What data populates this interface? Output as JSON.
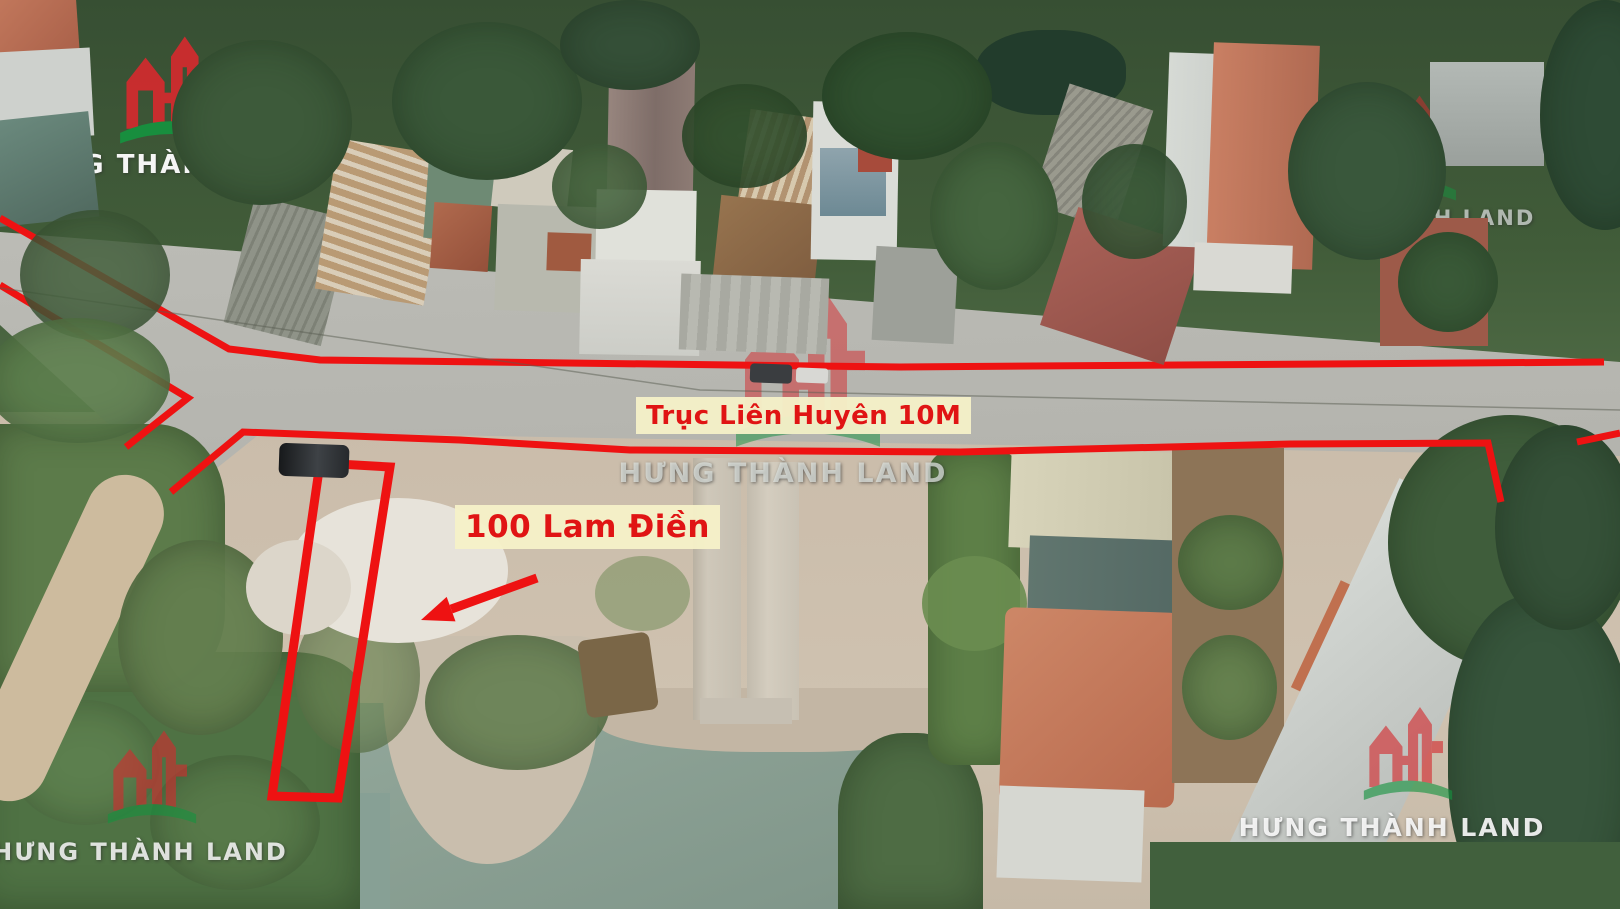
{
  "image": {
    "width": 1620,
    "height": 909
  },
  "watermarks": {
    "brand_text": "HƯNG THÀNH LAND",
    "logo_red": "#d42a2e",
    "logo_green": "#15933f",
    "instances": [
      {
        "id": "top-left",
        "cx": 170,
        "logo_x": 118,
        "logo_y": 22,
        "logo_w": 106,
        "logo_h": 136,
        "logo_o": 0.92,
        "text_y": 150,
        "text_size": 26,
        "text_color": "rgba(253,253,253,0.96)"
      },
      {
        "id": "center",
        "cx": 783,
        "logo_x": 733,
        "logo_y": 283,
        "logo_w": 150,
        "logo_h": 176,
        "logo_o": 0.5,
        "text_y": 458,
        "text_size": 27,
        "text_color": "rgba(222,227,223,0.75)"
      },
      {
        "id": "right",
        "cx": 1404,
        "logo_x": 1354,
        "logo_y": 86,
        "logo_w": 104,
        "logo_h": 124,
        "logo_o": 0.5,
        "text_y": 206,
        "text_size": 21,
        "text_color": "rgba(206,212,208,0.8)"
      },
      {
        "id": "bottom-left",
        "cx": 140,
        "logo_x": 106,
        "logo_y": 720,
        "logo_w": 92,
        "logo_h": 114,
        "logo_o": 0.6,
        "text_y": 838,
        "text_size": 24,
        "text_color": "rgba(250,250,250,0.85)"
      },
      {
        "id": "bottom-right",
        "cx": 1392,
        "logo_x": 1362,
        "logo_y": 696,
        "logo_w": 92,
        "logo_h": 115,
        "logo_o": 0.62,
        "text_y": 813,
        "text_size": 25,
        "text_color": "rgba(252,252,252,0.9)"
      }
    ]
  },
  "annotations": {
    "color": "#ee1212",
    "stroke_width": 7,
    "road_label": {
      "text": "Trục Liên Huyên 10M",
      "x": 636,
      "y": 397,
      "w": 312,
      "h": 37,
      "font_size": 26,
      "text_color": "#e01414",
      "bg_color": "rgba(245,241,200,0.95)"
    },
    "plot_label": {
      "text": "100 Lam Điền",
      "x": 455,
      "y": 505,
      "w": 214,
      "h": 44,
      "font_size": 31,
      "text_color": "#e01414",
      "bg_color": "rgba(245,241,200,0.95)"
    },
    "lines": [
      {
        "name": "road-top-edge-line",
        "points": [
          [
            0,
            218
          ],
          [
            229,
            349
          ],
          [
            320,
            360
          ],
          [
            900,
            367
          ],
          [
            1604,
            362
          ]
        ]
      },
      {
        "name": "road-left-branch-line",
        "points": [
          [
            0,
            285
          ],
          [
            188,
            398
          ],
          [
            126,
            447
          ]
        ]
      },
      {
        "name": "road-bottom-edge-line",
        "points": [
          [
            171,
            492
          ],
          [
            243,
            432
          ],
          [
            460,
            440
          ],
          [
            630,
            450
          ],
          [
            960,
            452
          ],
          [
            1290,
            444
          ],
          [
            1488,
            443
          ],
          [
            1501,
            502
          ]
        ]
      },
      {
        "name": "road-bottom-edge-line-right",
        "points": [
          [
            1577,
            442
          ],
          [
            1620,
            433
          ]
        ]
      },
      {
        "name": "power-line",
        "points": [
          [
            0,
            288
          ],
          [
            700,
            390
          ],
          [
            1620,
            410
          ]
        ],
        "stroke": "#5a5d52",
        "width": 1.5,
        "opacity": 0.5
      }
    ],
    "plot_outline": {
      "points": [
        [
          320,
          463
        ],
        [
          390,
          467
        ],
        [
          338,
          798
        ],
        [
          272,
          796
        ]
      ],
      "stroke_width": 9
    },
    "arrow": {
      "tail": [
        537,
        578
      ],
      "head": [
        421,
        620
      ],
      "stroke_width": 9
    }
  },
  "scene": {
    "elements": [
      {
        "n": "tree-canopy-top",
        "x": 0,
        "y": 0,
        "w": 1620,
        "h": 448,
        "bg": "linear-gradient(180deg,#374f33 0%,#415c39 55%,#54704a 100%)"
      },
      {
        "n": "ground-lot",
        "x": 0,
        "y": 412,
        "w": 1620,
        "h": 497,
        "bg": "linear-gradient(180deg,#cabcaa,#cfc2b0 60%,#c6b9a7)"
      },
      {
        "n": "road",
        "x": 0,
        "y": 210,
        "w": 1620,
        "h": 266,
        "bg": "linear-gradient(178deg,#bcbcb6,#b3b3ad)",
        "clip": "0px 22px,1620px 152px,1620px 246px,262px 222px,212px 262px,150px 252px,0px 115px"
      },
      {
        "n": "pond-water",
        "x": 295,
        "y": 703,
        "w": 655,
        "h": 206,
        "bg": "linear-gradient(160deg,#93a89b,#7e9488)"
      },
      {
        "n": "pond-inlet-left",
        "x": 298,
        "y": 793,
        "w": 92,
        "h": 116,
        "c": "#87a095"
      },
      {
        "n": "lot-peninsula",
        "x": 383,
        "y": 636,
        "w": 216,
        "h": 228,
        "c": "#c9bead",
        "br": "6% 10% 52% 48% / 4% 6% 72% 76%"
      },
      {
        "n": "lot-shore-strip",
        "x": 598,
        "y": 688,
        "w": 352,
        "h": 64,
        "c": "#c3b6a4",
        "br": "0 0 40% 45%"
      },
      {
        "n": "hyacinth-mat",
        "x": -25,
        "y": 652,
        "w": 385,
        "h": 257,
        "c": "#4f7244",
        "br": "36% 18% 0 0 / 22% 14% 0 0",
        "soft": 1
      },
      {
        "n": "hyacinth-patch",
        "x": 10,
        "y": 700,
        "w": 150,
        "h": 125,
        "c": "#5f8250",
        "br": "50%",
        "o": 0.85,
        "soft": 1
      },
      {
        "n": "hyacinth-patch",
        "x": 150,
        "y": 755,
        "w": 170,
        "h": 135,
        "c": "#587a4a",
        "br": "50%",
        "o": 0.9,
        "soft": 1
      },
      {
        "n": "bank-vegetation-left",
        "x": -10,
        "y": 424,
        "w": 235,
        "h": 268,
        "c": "#5c7b4a",
        "br": "0 30% 30% 0",
        "soft": 1
      },
      {
        "n": "dirt-footpath",
        "x": 28,
        "y": 462,
        "w": 78,
        "h": 352,
        "c": "#cdbb9e",
        "r": 25,
        "br": "40px"
      },
      {
        "n": "lot-shrub",
        "x": 118,
        "y": 540,
        "w": 165,
        "h": 195,
        "c": "#647f4f",
        "br": "50%",
        "o": 0.95,
        "soft": 1
      },
      {
        "n": "lot-shrub",
        "x": 295,
        "y": 598,
        "w": 125,
        "h": 155,
        "c": "#6d8655",
        "br": "50%",
        "o": 0.7,
        "soft": 1
      },
      {
        "n": "lot-shrub",
        "x": 425,
        "y": 635,
        "w": 185,
        "h": 135,
        "c": "#5f7c4c",
        "br": "50%",
        "o": 0.85,
        "soft": 1
      },
      {
        "n": "lot-shrub",
        "x": 595,
        "y": 556,
        "w": 95,
        "h": 75,
        "c": "#7b9160",
        "br": "50%",
        "o": 0.6
      },
      {
        "n": "rubble-pile",
        "x": 288,
        "y": 498,
        "w": 220,
        "h": 145,
        "c": "#e7e3da",
        "br": "50%"
      },
      {
        "n": "rubble-pile",
        "x": 246,
        "y": 540,
        "w": 105,
        "h": 95,
        "c": "#dcd6ca",
        "br": "50%"
      },
      {
        "n": "concrete-strip",
        "x": 693,
        "y": 458,
        "w": 48,
        "h": 262,
        "bg": "linear-gradient(90deg,#b9b1a2,#cfc8ba 30%,#c5beb0)"
      },
      {
        "n": "concrete-strip",
        "x": 747,
        "y": 462,
        "w": 52,
        "h": 258,
        "bg": "linear-gradient(90deg,#c2bbad,#d4cdbf 40%,#c9c2b4)"
      },
      {
        "n": "concrete-pad",
        "x": 700,
        "y": 698,
        "w": 92,
        "h": 26,
        "c": "#c6bfb2"
      },
      {
        "n": "lakeside-hut",
        "x": 582,
        "y": 636,
        "w": 72,
        "h": 78,
        "c": "#7a6647",
        "r": -8,
        "br": "8px"
      },
      {
        "n": "shore-vegetation",
        "x": 838,
        "y": 733,
        "w": 145,
        "h": 176,
        "c": "#4e6c44",
        "br": "45% 45% 0 0",
        "soft": 1
      },
      {
        "n": "banana-strip",
        "x": 928,
        "y": 450,
        "w": 92,
        "h": 315,
        "c": "#5e8048",
        "br": "24px",
        "soft": 1
      },
      {
        "n": "banana-clump",
        "x": 922,
        "y": 556,
        "w": 105,
        "h": 95,
        "c": "#6a8d50",
        "br": "50%",
        "o": 0.9
      },
      {
        "n": "warehouse-roof-light",
        "x": 1010,
        "y": 450,
        "w": 165,
        "h": 100,
        "bg": "linear-gradient(90deg,#d8d4ba,#c8c4aa)",
        "r": 2
      },
      {
        "n": "warehouse-roof-dark",
        "x": 1028,
        "y": 538,
        "w": 150,
        "h": 110,
        "bg": "linear-gradient(90deg,#61766f,#546964)",
        "r": 2
      },
      {
        "n": "hip-roof-house-salmon",
        "x": 1002,
        "y": 610,
        "w": 175,
        "h": 195,
        "bg": "linear-gradient(135deg,#cd8767,#b96a4e)",
        "r": 2,
        "br": "10px"
      },
      {
        "n": "house-wall-white",
        "x": 998,
        "y": 788,
        "w": 145,
        "h": 92,
        "c": "#d6d7d1",
        "r": 2
      },
      {
        "n": "garden-plot",
        "x": 1172,
        "y": 448,
        "w": 112,
        "h": 335,
        "c": "#8d7457"
      },
      {
        "n": "garden-shrub",
        "x": 1178,
        "y": 515,
        "w": 105,
        "h": 95,
        "c": "#5d7b49",
        "br": "50%",
        "soft": 1
      },
      {
        "n": "garden-shrub",
        "x": 1182,
        "y": 635,
        "w": 95,
        "h": 105,
        "c": "#66824f",
        "br": "50%",
        "soft": 1
      },
      {
        "n": "long-building-upper",
        "x": 1412,
        "y": 462,
        "w": 115,
        "h": 140,
        "c": "#c6cbc7",
        "r": 25
      },
      {
        "n": "orange-roof-corner",
        "x": 1312,
        "y": 592,
        "w": 82,
        "h": 118,
        "c": "#c0704f",
        "r": 25
      },
      {
        "n": "long-building-gray",
        "x": 1302,
        "y": 488,
        "w": 142,
        "h": 430,
        "bg": "linear-gradient(115deg,#d6dad6,#b7bbb7)",
        "r": 25
      },
      {
        "n": "tree-cluster",
        "x": 1388,
        "y": 415,
        "w": 245,
        "h": 255,
        "c": "#3f5d3b",
        "br": "50%",
        "soft": 1
      },
      {
        "n": "tree-cluster",
        "x": 1448,
        "y": 595,
        "w": 185,
        "h": 330,
        "c": "#37553c",
        "br": "45%",
        "soft": 1
      },
      {
        "n": "tree-cluster",
        "x": 1495,
        "y": 425,
        "w": 140,
        "h": 205,
        "c": "#355138",
        "br": "50%",
        "soft": 1
      },
      {
        "n": "shore-vegetation",
        "x": 1150,
        "y": 842,
        "w": 490,
        "h": 70,
        "c": "#41603d"
      },
      {
        "n": "roof-orange-tl",
        "x": -6,
        "y": -8,
        "w": 84,
        "h": 74,
        "bg": "linear-gradient(135deg,#c3795d,#a85f48)",
        "r": -4
      },
      {
        "n": "building-white-tl",
        "x": -4,
        "y": 50,
        "w": 96,
        "h": 88,
        "c": "#ced1cd",
        "r": -3
      },
      {
        "n": "roof-teal-tl",
        "x": -6,
        "y": 116,
        "w": 100,
        "h": 106,
        "bg": "linear-gradient(160deg,#6b8a7e,#50695f)",
        "r": -6
      },
      {
        "n": "roof-corrugated-gray",
        "x": 238,
        "y": 206,
        "w": 100,
        "h": 130,
        "bg": "repeating-linear-gradient(100deg,#8f9388 0px,#8f9388 6px,#7d8176 6px,#7d8176 9px)",
        "r": 14
      },
      {
        "n": "roof-rust-striped",
        "x": 326,
        "y": 146,
        "w": 110,
        "h": 152,
        "bg": "repeating-linear-gradient(10deg,#b99a74 0px,#b99a74 7px,#d9cdb8 7px,#d9cdb8 12px)",
        "r": 9
      },
      {
        "n": "roof-green-shed",
        "x": 436,
        "y": 90,
        "w": 104,
        "h": 94,
        "bg": "linear-gradient(180deg,#64836d,#4f6a58)",
        "r": 4
      },
      {
        "n": "roof-green-shed",
        "x": 426,
        "y": 160,
        "w": 66,
        "h": 80,
        "c": "#6e8a74",
        "r": 4
      },
      {
        "n": "roof-red-tile-small",
        "x": 432,
        "y": 204,
        "w": 58,
        "h": 66,
        "bg": "linear-gradient(135deg,#b06a4e,#94503a)",
        "r": 4
      },
      {
        "n": "shed-white",
        "x": 494,
        "y": 146,
        "w": 76,
        "h": 64,
        "c": "#cfcabc",
        "r": 6
      },
      {
        "n": "house-concrete-flat",
        "x": 496,
        "y": 206,
        "w": 122,
        "h": 106,
        "c": "#b8b9ae",
        "r": 2
      },
      {
        "n": "roof-red-gable-small",
        "x": 547,
        "y": 233,
        "w": 44,
        "h": 38,
        "c": "#a05a40",
        "r": 2
      },
      {
        "n": "church-roof",
        "x": 608,
        "y": 50,
        "w": 86,
        "h": 158,
        "bg": "linear-gradient(90deg,#97857e,#7e6d68 55%,#8d7b74)",
        "r": 1
      },
      {
        "n": "church-body",
        "x": 596,
        "y": 190,
        "w": 100,
        "h": 80,
        "c": "#e0e1da",
        "r": 1
      },
      {
        "n": "church-courtyard",
        "x": 580,
        "y": 260,
        "w": 120,
        "h": 95,
        "bg": "linear-gradient(180deg,#dbdbd5,#cccdc7)",
        "r": 1
      },
      {
        "n": "roof-rust-striped",
        "x": 742,
        "y": 114,
        "w": 82,
        "h": 118,
        "bg": "repeating-linear-gradient(100deg,#b29371 0px,#b29371 6px,#d7c9ae 6px,#d7c9ae 11px)",
        "r": 8
      },
      {
        "n": "roof-brown-hip",
        "x": 716,
        "y": 200,
        "w": 102,
        "h": 96,
        "bg": "linear-gradient(135deg,#97744f,#7d5b3e)",
        "r": 6
      },
      {
        "n": "warehouse-roof-gray",
        "x": 680,
        "y": 276,
        "w": 148,
        "h": 76,
        "bg": "repeating-linear-gradient(92deg,#a8a9a1 0px,#a8a9a1 10px,#b8b9b1 10px,#b8b9b1 20px)",
        "r": 2
      },
      {
        "n": "building-modern-white",
        "x": 812,
        "y": 102,
        "w": 86,
        "h": 158,
        "c": "#dadcd7",
        "r": 1
      },
      {
        "n": "glass-facade",
        "x": 820,
        "y": 148,
        "w": 66,
        "h": 68,
        "bg": "linear-gradient(180deg,#8fa4ad,#6d8994)"
      },
      {
        "n": "roof-red-patch",
        "x": 858,
        "y": 142,
        "w": 34,
        "h": 30,
        "c": "#a74b3b"
      },
      {
        "n": "roof-gray-small",
        "x": 874,
        "y": 248,
        "w": 82,
        "h": 94,
        "c": "#9da099",
        "r": 3
      },
      {
        "n": "pond-top-right",
        "x": 976,
        "y": 30,
        "w": 150,
        "h": 85,
        "c": "#223c2c",
        "br": "45%"
      },
      {
        "n": "roof-shingle-gray",
        "x": 1048,
        "y": 94,
        "w": 88,
        "h": 126,
        "bg": "repeating-linear-gradient(115deg,#9a9a8e 0px,#9a9a8e 5px,#85857b 5px,#85857b 8px)",
        "r": 18
      },
      {
        "n": "roof-maroon",
        "x": 1056,
        "y": 224,
        "w": 130,
        "h": 124,
        "bg": "linear-gradient(135deg,#aa6258,#8f4e46)",
        "r": 18
      },
      {
        "n": "roof-white-long",
        "x": 1166,
        "y": 54,
        "w": 106,
        "h": 194,
        "bg": "linear-gradient(90deg,#d6dad5,#c3c7c3)",
        "r": 2
      },
      {
        "n": "roof-salmon-long",
        "x": 1210,
        "y": 44,
        "w": 106,
        "h": 224,
        "bg": "linear-gradient(90deg,#c97f63,#b06a52)",
        "r": 2
      },
      {
        "n": "house-wall-white",
        "x": 1194,
        "y": 244,
        "w": 98,
        "h": 48,
        "c": "#d9d9d3",
        "r": 2
      },
      {
        "n": "courtyard-red",
        "x": 1380,
        "y": 218,
        "w": 108,
        "h": 128,
        "c": "#9d5a49"
      },
      {
        "n": "tree-blob",
        "x": 1398,
        "y": 232,
        "w": 100,
        "h": 100,
        "c": "#3a5a38",
        "br": "50%",
        "soft": 1
      },
      {
        "n": "roof-metal-gray",
        "x": 1430,
        "y": 62,
        "w": 114,
        "h": 104,
        "bg": "linear-gradient(180deg,#b3b9b5,#9aa09c)"
      },
      {
        "n": "vehicle-dark",
        "x": 750,
        "y": 364,
        "w": 42,
        "h": 19,
        "c": "#3a3d40",
        "br": "4px",
        "r": 2
      },
      {
        "n": "vehicle-light",
        "x": 796,
        "y": 368,
        "w": 32,
        "h": 15,
        "c": "#d8d8d4",
        "br": "3px",
        "r": 2
      },
      {
        "n": "tree-canopy",
        "x": 392,
        "y": 22,
        "w": 190,
        "h": 158,
        "c": "#3a5839",
        "br": "50%",
        "soft": 1
      },
      {
        "n": "tree-canopy",
        "x": 552,
        "y": 144,
        "w": 95,
        "h": 85,
        "c": "#4c6a44",
        "br": "50%",
        "o": 0.9,
        "soft": 1
      },
      {
        "n": "tree-canopy",
        "x": 560,
        "y": 0,
        "w": 140,
        "h": 90,
        "c": "#355038",
        "br": "50%",
        "soft": 1
      },
      {
        "n": "tree-canopy",
        "x": 822,
        "y": 32,
        "w": 170,
        "h": 128,
        "c": "#30502f",
        "br": "50%",
        "soft": 1
      },
      {
        "n": "tree-canopy",
        "x": 930,
        "y": 142,
        "w": 128,
        "h": 148,
        "c": "#45653f",
        "br": "50%",
        "soft": 1
      },
      {
        "n": "tree-canopy",
        "x": 1082,
        "y": 144,
        "w": 105,
        "h": 115,
        "c": "#3c5a3a",
        "br": "50%",
        "o": 0.92,
        "soft": 1
      },
      {
        "n": "tree-canopy",
        "x": 1288,
        "y": 82,
        "w": 158,
        "h": 178,
        "c": "#39573b",
        "br": "50%",
        "soft": 1
      },
      {
        "n": "tree-canopy",
        "x": 1540,
        "y": 0,
        "w": 130,
        "h": 230,
        "c": "#2e4b35",
        "br": "50%",
        "soft": 1
      },
      {
        "n": "tree-canopy",
        "x": 682,
        "y": 84,
        "w": 125,
        "h": 104,
        "c": "#33512f",
        "br": "50%",
        "o": 0.9,
        "soft": 1
      },
      {
        "n": "tree-canopy",
        "x": 172,
        "y": 40,
        "w": 180,
        "h": 165,
        "c": "#3d5a3a",
        "br": "50%",
        "soft": 1
      },
      {
        "n": "tree-canopy",
        "x": 20,
        "y": 210,
        "w": 150,
        "h": 130,
        "c": "#44603d",
        "br": "50%",
        "o": 0.85,
        "soft": 1
      },
      {
        "n": "banana-clump",
        "x": -15,
        "y": 318,
        "w": 185,
        "h": 125,
        "c": "#5d7f4d",
        "br": "50%",
        "o": 0.9,
        "soft": 1
      },
      {
        "n": "pickup-truck",
        "x": 279,
        "y": 444,
        "w": 70,
        "h": 33,
        "bg": "linear-gradient(90deg,#17191b,#3e4246 55%,#26292c)",
        "br": "7px",
        "r": 2
      }
    ]
  }
}
